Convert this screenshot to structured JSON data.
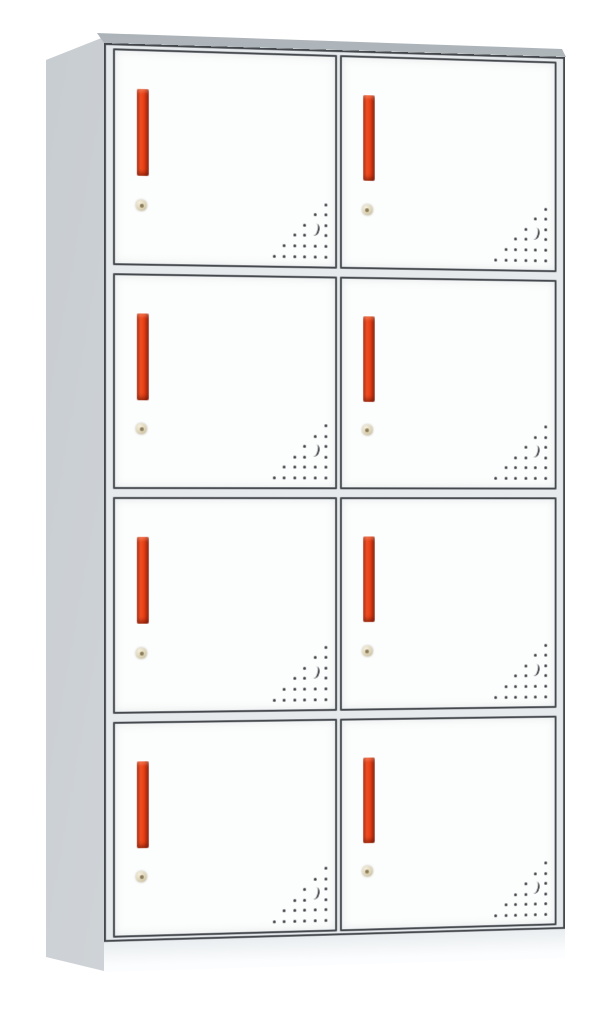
{
  "scene": {
    "description": "Product photo of a white metal locker storage cabinet with eight doors",
    "view": "front-left three-quarter view on plain white background"
  },
  "cabinet": {
    "rows": 4,
    "columns": 2,
    "door_count": 8,
    "features_per_door": {
      "handle": "vertical recessed red pull handle, upper-left of door",
      "lock": "small round beige cam keyhole lock below the handle",
      "vents": "triangular grid of perforation holes with crescent slot, bottom-right corner"
    }
  },
  "vent_pattern": {
    "rows": 6,
    "cols": 6,
    "rule": "dot present where col >= rows-1-row (lower-right triangle)",
    "spacing_px": 10.6,
    "crescent_skip": [
      [
        2,
        4
      ],
      [
        3,
        4
      ]
    ],
    "crescent_pos": {
      "left": 38,
      "top": 20
    }
  },
  "colors": {
    "background": "#ffffff",
    "door_face": "#fcfdfd",
    "frame": "#e7eaed",
    "outline": "#45494e",
    "side_panel": "#ccd1d5",
    "top_edge": "#aab1b6",
    "handle_red": "#e8421c",
    "handle_dark": "#8f2010",
    "lock_body": "#ddd4b8",
    "lock_center": "#8a7a58",
    "vent_dot": "#3a3d40",
    "base": "#f2f4f6"
  }
}
